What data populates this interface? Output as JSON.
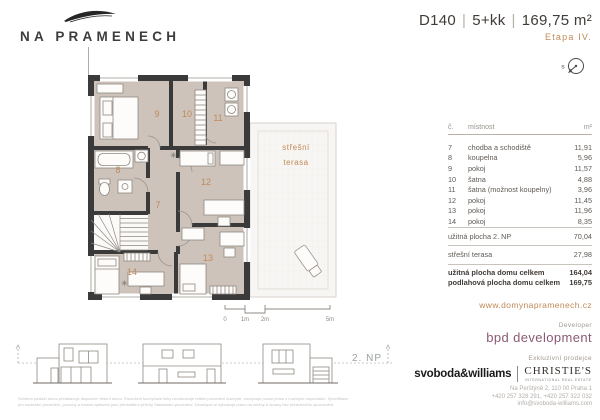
{
  "colors": {
    "accent": "#c08a58",
    "wall": "#3a3a3a",
    "room_fill": "#cdc3bb",
    "bpd": "#8a5a74"
  },
  "brand": {
    "logo_text": "NA PRAMENECH",
    "website": "www.domynapramenech.cz"
  },
  "header": {
    "unit": "D140",
    "layout": "5+kk",
    "area": "169,75 m²",
    "stage": "Etapa IV.",
    "compass_label": "s"
  },
  "floor_plan": {
    "floor_label": "2. NP",
    "terrace_label_line1": "střešní",
    "terrace_label_line2": "terasa",
    "room_labels": [
      "7",
      "8",
      "9",
      "10",
      "11",
      "12",
      "13",
      "14"
    ],
    "scale": {
      "t0": "0",
      "t1": "1m",
      "t2": "2m",
      "t5": "5m"
    }
  },
  "room_table": {
    "headers": {
      "no": "č.",
      "name": "místnost",
      "unit": "m²"
    },
    "rows": [
      {
        "no": "7",
        "name": "chodba a schodiště",
        "area": "11,91"
      },
      {
        "no": "8",
        "name": "koupelna",
        "area": "5,96"
      },
      {
        "no": "9",
        "name": "pokoj",
        "area": "11,57"
      },
      {
        "no": "10",
        "name": "šatna",
        "area": "4,88"
      },
      {
        "no": "11",
        "name": "šatna (možnost koupelny)",
        "area": "3,96"
      },
      {
        "no": "12",
        "name": "pokoj",
        "area": "11,45"
      },
      {
        "no": "13",
        "name": "pokoj",
        "area": "11,96"
      },
      {
        "no": "14",
        "name": "pokoj",
        "area": "8,35"
      }
    ],
    "subtotals": [
      {
        "name": "užitná plocha 2. NP",
        "area": "70,04"
      },
      {
        "name": "střešní terasa",
        "area": "27,98"
      }
    ],
    "totals": [
      {
        "name": "užitná plocha domu celkem",
        "area": "164,04"
      },
      {
        "name": "podlahová plocha domu celkem",
        "area": "169,75"
      }
    ]
  },
  "footer": {
    "developer_label": "Developer",
    "developer_name": "bpd development",
    "broker_label": "Exkluzivní prodejce",
    "broker1": "svoboda&williams",
    "broker2": "CHRISTIE'S",
    "broker2_sub": "INTERNATIONAL REAL ESTATE",
    "address": "Na Perštýně 2, 110 00 Praha 1",
    "phones": "+420 257 328 291, +420 257 322 032",
    "email": "info@svoboda-williams.com",
    "disclaimer_line1": "Schéma podlaží domu představuje dispoziční řešení domu. Rozvržení kuchyňské linky nezobrazuje reálné provedení kuchyně, zachycuje pouze jedno z možných uspořádání. Specifikace",
    "disclaimer_line2": "pro konkrétní provedení, povrchy a rozsah vybavení jsou předmětem přílohy Standardní provedení. Developer si vyhrazuje právo na změny a úpravy bez předchozího upozornění."
  }
}
